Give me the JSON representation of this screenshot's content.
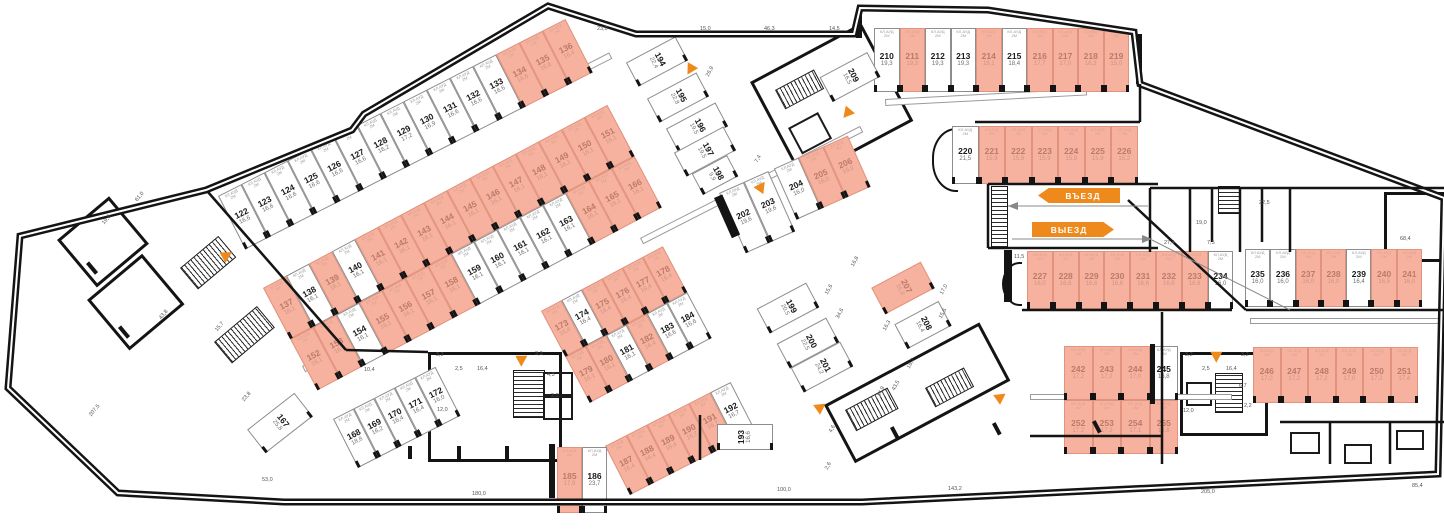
{
  "palette": {
    "highlight": "#f6b29e",
    "highlight_border": "#e1937e",
    "accent": "#ee8a1c",
    "wall": "#141414",
    "dim_text": "#555555"
  },
  "signs": {
    "entry": "ВЪЕЗД",
    "exit": "ВЫЕЗД"
  },
  "unit_tag": "КЛ.АУД\n2М",
  "groups": [
    {
      "x": 218,
      "y": 196,
      "r": -27,
      "cw": 26,
      "ch": 60,
      "rows": [
        [
          [
            122,
            "16,6",
            0
          ],
          [
            123,
            "16,6",
            0
          ],
          [
            124,
            "16,6",
            0
          ],
          [
            125,
            "16,6",
            0
          ],
          [
            126,
            "16,6",
            0
          ],
          [
            127,
            "16,6",
            0
          ],
          [
            128,
            "16,2",
            0
          ],
          [
            129,
            "17,2",
            0
          ],
          [
            130,
            "16,9",
            0
          ],
          [
            131,
            "16,6",
            0
          ],
          [
            132,
            "16,6",
            0
          ],
          [
            133,
            "16,6",
            0
          ],
          [
            134,
            "16,6",
            1
          ],
          [
            135,
            "16,6",
            1
          ],
          [
            136,
            "16,4",
            1
          ]
        ]
      ]
    },
    {
      "x": 263,
      "y": 288,
      "r": -28,
      "cw": 26,
      "ch": 58,
      "rows": [
        [
          [
            137,
            "16,1",
            1
          ],
          [
            138,
            "16,1",
            0
          ],
          [
            139,
            "16,1",
            1
          ],
          [
            140,
            "16,1",
            0
          ],
          [
            141,
            "16,1",
            1
          ],
          [
            142,
            "16,1",
            1
          ],
          [
            143,
            "16,1",
            1
          ],
          [
            144,
            "16,1",
            1
          ],
          [
            145,
            "16,1",
            1
          ],
          [
            146,
            "16,1",
            1
          ],
          [
            147,
            "16,1",
            1
          ],
          [
            148,
            "16,1",
            1
          ],
          [
            149,
            "16,1",
            1
          ],
          [
            150,
            "16,1",
            1
          ],
          [
            151,
            "16,1",
            1
          ]
        ],
        [
          [
            152,
            "16,1",
            1
          ],
          [
            153,
            "16,1",
            1
          ],
          [
            154,
            "16,1",
            0
          ],
          [
            155,
            "16,1",
            1
          ],
          [
            156,
            "16,1",
            1
          ],
          [
            157,
            "16,1",
            1
          ],
          [
            158,
            "16,1",
            1
          ],
          [
            159,
            "16,1",
            0
          ],
          [
            160,
            "16,1",
            0
          ],
          [
            161,
            "16,1",
            0
          ],
          [
            162,
            "16,1",
            0
          ],
          [
            163,
            "16,1",
            0
          ],
          [
            164,
            "16,1",
            1
          ],
          [
            165,
            "16,1",
            1
          ],
          [
            166,
            "16,1",
            1
          ]
        ]
      ]
    },
    {
      "x": 333,
      "y": 419,
      "r": -27,
      "cw": 23,
      "ch": 55,
      "rows": [
        [
          [
            168,
            "18,8",
            0
          ],
          [
            169,
            "16,2",
            0
          ],
          [
            170,
            "16,4",
            0
          ],
          [
            171,
            "16,4",
            0
          ],
          [
            172,
            "16,0",
            0
          ]
        ]
      ]
    },
    {
      "x": 541,
      "y": 311,
      "r": -28,
      "cw": 23,
      "ch": 52,
      "rows": [
        [
          [
            173,
            "16,4",
            1
          ],
          [
            174,
            "16,4",
            0
          ],
          [
            175,
            "16,4",
            1
          ],
          [
            176,
            "16,4",
            1
          ],
          [
            177,
            "16,4",
            1
          ],
          [
            178,
            "16,4",
            1
          ]
        ],
        [
          [
            179,
            "16,1",
            1
          ],
          [
            180,
            "16,1",
            1
          ],
          [
            181,
            "16,1",
            0
          ],
          [
            182,
            "16,4",
            1
          ],
          [
            183,
            "16,6",
            0
          ],
          [
            184,
            "16,6",
            0
          ]
        ]
      ]
    },
    {
      "x": 605,
      "y": 446,
      "r": -27,
      "cw": 23.5,
      "ch": 55,
      "rows": [
        [
          [
            187,
            "16,4",
            1
          ],
          [
            188,
            "16,4",
            1
          ],
          [
            189,
            "16,4",
            1
          ],
          [
            190,
            "16,7",
            1
          ],
          [
            191,
            "16,7",
            1
          ],
          [
            192,
            "16,7",
            0
          ]
        ]
      ]
    },
    {
      "x": 557,
      "y": 447,
      "r": 0,
      "cw": 25,
      "ch": 66,
      "rows": [
        [
          [
            185,
            "17,9",
            1
          ],
          [
            186,
            "23,7",
            0
          ]
        ]
      ]
    },
    {
      "x": 719,
      "y": 193,
      "r": -24,
      "cw": 27,
      "ch": 66,
      "rows": [
        [
          [
            202,
            "19,6",
            0
          ],
          [
            203,
            "19,6",
            0
          ],
          [
            204,
            "16,0",
            0,
            {
              "h": 56,
              "ml": 6
            }
          ],
          [
            205,
            "16,0",
            1,
            {
              "h": 56
            }
          ],
          [
            206,
            "16,0",
            1,
            {
              "h": 56
            }
          ]
        ]
      ]
    },
    {
      "x": 874,
      "y": 28,
      "r": 0,
      "cw": 25.5,
      "ch": 64,
      "rows": [
        [
          [
            210,
            "19,3",
            0
          ],
          [
            211,
            "19,3",
            1
          ],
          [
            212,
            "19,3",
            0
          ],
          [
            213,
            "19,3",
            0
          ],
          [
            214,
            "19,1",
            1
          ],
          [
            215,
            "18,4",
            0
          ],
          [
            216,
            "17,7",
            1
          ],
          [
            217,
            "17,0",
            1
          ],
          [
            218,
            "16,3",
            1
          ],
          [
            219,
            "15,0",
            1
          ]
        ]
      ]
    },
    {
      "x": 952,
      "y": 126,
      "r": 0,
      "cw": 26.5,
      "ch": 58,
      "rows": [
        [
          [
            220,
            "21,5",
            0
          ],
          [
            221,
            "15,9",
            1
          ],
          [
            222,
            "15,9",
            1
          ],
          [
            223,
            "15,9",
            1
          ],
          [
            224,
            "15,9",
            1
          ],
          [
            225,
            "15,9",
            1
          ],
          [
            226,
            "15,2",
            1
          ]
        ]
      ]
    },
    {
      "x": 1027,
      "y": 251,
      "r": 0,
      "cw": 25.8,
      "ch": 58,
      "rows": [
        [
          [
            227,
            "16,0",
            1
          ],
          [
            228,
            "16,6",
            1
          ],
          [
            229,
            "16,6",
            1
          ],
          [
            230,
            "16,6",
            1
          ],
          [
            231,
            "16,6",
            1
          ],
          [
            232,
            "16,6",
            1
          ],
          [
            233,
            "16,6",
            1
          ],
          [
            234,
            "16,0",
            0
          ]
        ]
      ]
    },
    {
      "x": 1245,
      "y": 249,
      "r": 0,
      "cw": 25.3,
      "ch": 58,
      "rows": [
        [
          [
            235,
            "16,0",
            0
          ],
          [
            236,
            "16,0",
            0
          ],
          [
            237,
            "16,0",
            1
          ],
          [
            238,
            "16,0",
            1
          ],
          [
            239,
            "16,4",
            0
          ],
          [
            240,
            "16,5",
            1
          ],
          [
            241,
            "16,0",
            1
          ]
        ]
      ]
    },
    {
      "x": 1064,
      "y": 346,
      "r": 0,
      "cw": 28.5,
      "ch": 54,
      "rows": [
        [
          [
            242,
            "17,2",
            1
          ],
          [
            243,
            "17,2",
            1
          ],
          [
            244,
            "17,0",
            1
          ],
          [
            245,
            "16,8",
            0
          ]
        ],
        [
          [
            252,
            "17,2",
            1
          ],
          [
            253,
            "17,3",
            1
          ],
          [
            254,
            "17,1",
            1
          ],
          [
            255,
            "16,8",
            1
          ]
        ]
      ]
    },
    {
      "x": 1253,
      "y": 347,
      "r": 0,
      "cw": 27.5,
      "ch": 56,
      "rows": [
        [
          [
            246,
            "17,0",
            1
          ],
          [
            247,
            "17,2",
            1
          ],
          [
            248,
            "17,2",
            1
          ],
          [
            249,
            "17,0",
            1
          ],
          [
            250,
            "17,3",
            1
          ],
          [
            251,
            "17,4",
            1
          ]
        ]
      ]
    }
  ],
  "singles": [
    [
      194,
      "22,4",
      0,
      629,
      48,
      56,
      27,
      -28,
      90
    ],
    [
      195,
      "22,8",
      0,
      650,
      84,
      56,
      27,
      -28,
      90
    ],
    [
      196,
      "19,5",
      0,
      669,
      114,
      56,
      27,
      -28,
      90
    ],
    [
      197,
      "19,5",
      0,
      677,
      138,
      56,
      27,
      -28,
      90
    ],
    [
      198,
      "9,9",
      0,
      695,
      163,
      40,
      24,
      -28,
      90
    ],
    [
      199,
      "20,5",
      0,
      760,
      294,
      56,
      28,
      -28,
      90
    ],
    [
      200,
      "22,5",
      0,
      780,
      329,
      56,
      28,
      -28,
      90
    ],
    [
      201,
      "24,2",
      0,
      794,
      353,
      56,
      28,
      -28,
      90
    ],
    [
      207,
      "16,8",
      1,
      875,
      273,
      56,
      30,
      -28,
      90
    ],
    [
      208,
      "16,4",
      0,
      898,
      311,
      50,
      28,
      -28,
      90
    ],
    [
      209,
      "16,5",
      0,
      823,
      63,
      54,
      28,
      -28,
      90
    ],
    [
      167,
      "25,8",
      0,
      250,
      408,
      60,
      30,
      -38,
      90
    ],
    [
      193,
      "16,6",
      0,
      717,
      424,
      56,
      26,
      0,
      -90
    ]
  ],
  "dims": [
    [
      "23,0",
      597,
      26,
      0
    ],
    [
      "15,0",
      700,
      26,
      0
    ],
    [
      "46,3",
      764,
      26,
      0
    ],
    [
      "14,5",
      829,
      26,
      0
    ],
    [
      "68,4",
      1400,
      236,
      0
    ],
    [
      "27,4",
      1164,
      240,
      0
    ],
    [
      "7,5",
      1207,
      240,
      0
    ],
    [
      "22,5",
      1259,
      200,
      0
    ],
    [
      "19,0",
      1196,
      220,
      0
    ],
    [
      "11,5",
      1014,
      254,
      0
    ],
    [
      "3,2",
      436,
      352,
      0
    ],
    [
      "2,5",
      455,
      366,
      0
    ],
    [
      "16,4",
      477,
      366,
      0
    ],
    [
      "3,3",
      535,
      351,
      0
    ],
    [
      "4,3",
      547,
      372,
      0
    ],
    [
      "2,2",
      551,
      393,
      0
    ],
    [
      "12,0",
      437,
      407,
      0
    ],
    [
      "10,4",
      364,
      367,
      0
    ],
    [
      "3,2",
      1185,
      352,
      0
    ],
    [
      "3,2",
      1241,
      352,
      0
    ],
    [
      "2,5",
      1202,
      366,
      0
    ],
    [
      "16,4",
      1226,
      366,
      0
    ],
    [
      "12,0",
      1183,
      408,
      0
    ],
    [
      "6,7",
      1239,
      383,
      0
    ],
    [
      "2,2",
      1244,
      403,
      0
    ],
    [
      "53,0",
      262,
      477,
      0
    ],
    [
      "180,0",
      472,
      491,
      0
    ],
    [
      "100,0",
      777,
      487,
      0
    ],
    [
      "143,2",
      948,
      486,
      0
    ],
    [
      "205,0",
      1201,
      489,
      0
    ],
    [
      "85,4",
      1412,
      483,
      0
    ],
    [
      "19,8",
      101,
      222,
      -50
    ],
    [
      "61,0",
      134,
      199,
      -50
    ],
    [
      "43,8",
      158,
      317,
      -50
    ],
    [
      "15,7",
      214,
      329,
      -50
    ],
    [
      "23,8",
      241,
      399,
      -50
    ],
    [
      "207,5",
      88,
      414,
      -50
    ],
    [
      "26,9",
      705,
      75,
      -62
    ],
    [
      "7,4",
      754,
      161,
      -62
    ],
    [
      "16,8",
      850,
      265,
      -62
    ],
    [
      "15,6",
      824,
      293,
      -62
    ],
    [
      "34,6",
      835,
      317,
      -62
    ],
    [
      "16,3",
      882,
      329,
      -62
    ],
    [
      "17,0",
      939,
      293,
      -62
    ],
    [
      "15,6",
      938,
      317,
      -62
    ],
    [
      "16,7",
      906,
      367,
      -62
    ],
    [
      "43,5",
      891,
      389,
      -62
    ],
    [
      "14,9",
      876,
      395,
      -62
    ],
    [
      "4,6",
      828,
      431,
      -62
    ],
    [
      "2,6",
      824,
      468,
      -62
    ]
  ]
}
